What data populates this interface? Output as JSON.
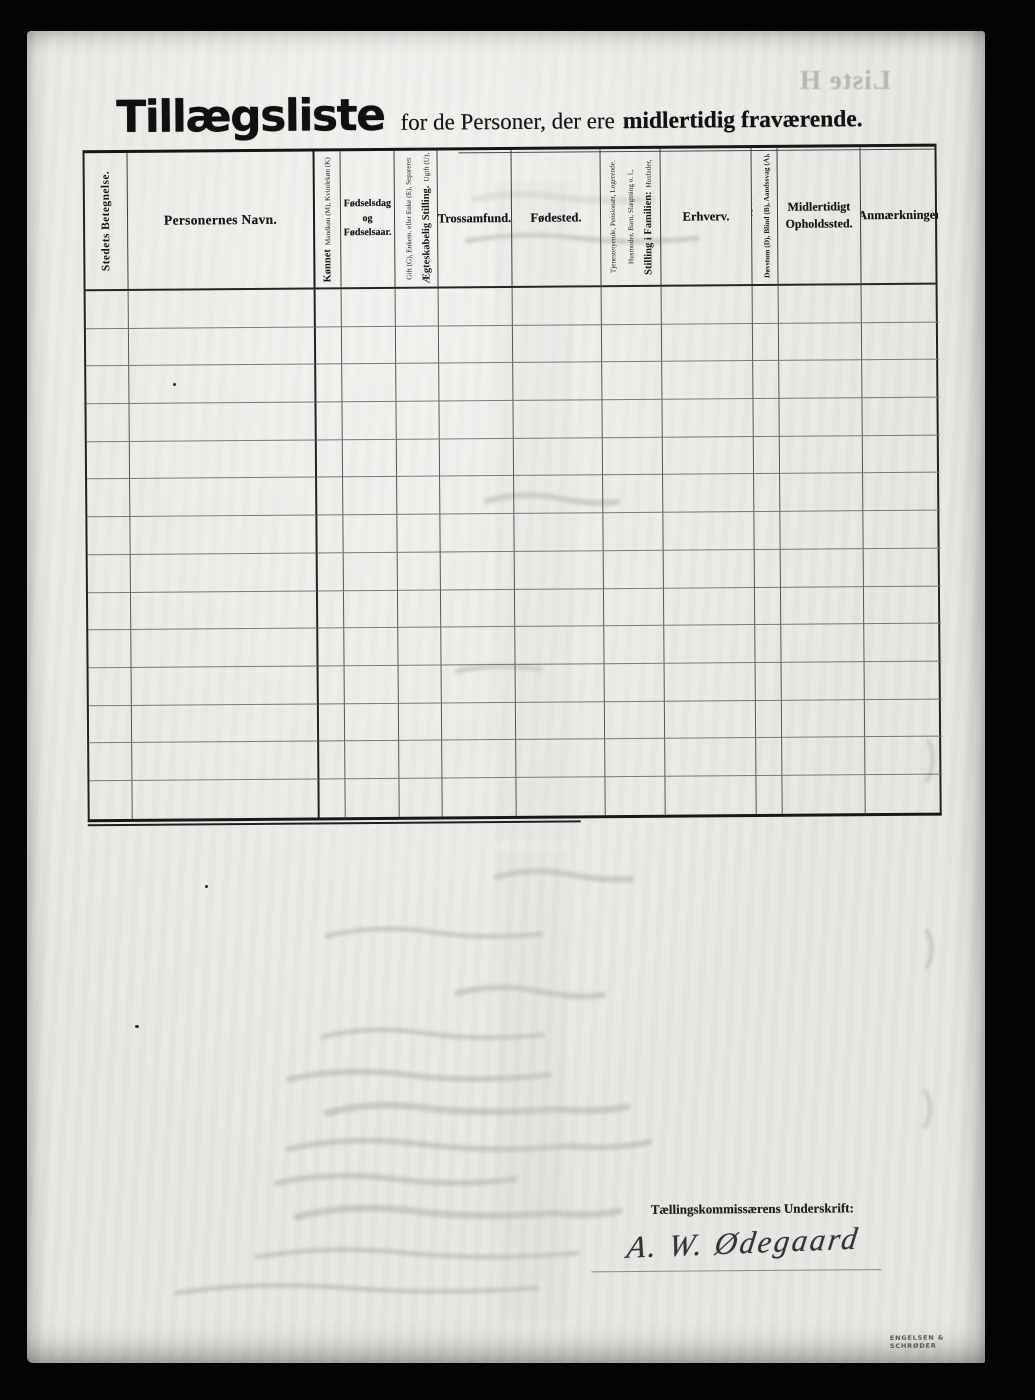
{
  "document": {
    "title_main": "Tillægsliste",
    "title_rest_regular": "for de Personer, der ere",
    "title_rest_bold": "midlertidig fraværende.",
    "bleedthrough_text": "Liste H",
    "printer_mark": "ENGELSEN & SCHRØDER"
  },
  "table": {
    "row_count": 14,
    "columns": [
      {
        "label": "Stedets Betegnelse."
      },
      {
        "label": "Personernes Navn."
      },
      {
        "label": "Kønnet",
        "sub": "Mandkøn (M), Kvindekøn (K)"
      },
      {
        "label": "Fødselsdag og Fødselsaar."
      },
      {
        "label": "Ægteskabelig Stilling.",
        "sub": "Ugift (U), Gift (G), Enkem. eller Enke (E), Separeret (S), Fraskilt (F)"
      },
      {
        "label": "Trossamfund."
      },
      {
        "label": "Fødested."
      },
      {
        "label": "Stilling i Familien:",
        "sub": "Husfader, Husmoder, Barn, Slægtning o. l., Tjenestetyende, Pensionær, Logerende."
      },
      {
        "label": "Erhverv."
      },
      {
        "label": "Døvstum (D), Blind (B), Aandssvag (A), Sindssyg (S)."
      },
      {
        "label": "Midlertidigt Opholdssted."
      },
      {
        "label": "Anmærkninger"
      }
    ]
  },
  "signature": {
    "label": "Tællingskommissærens Underskrift:",
    "value": "A. W. Ødegaard"
  }
}
